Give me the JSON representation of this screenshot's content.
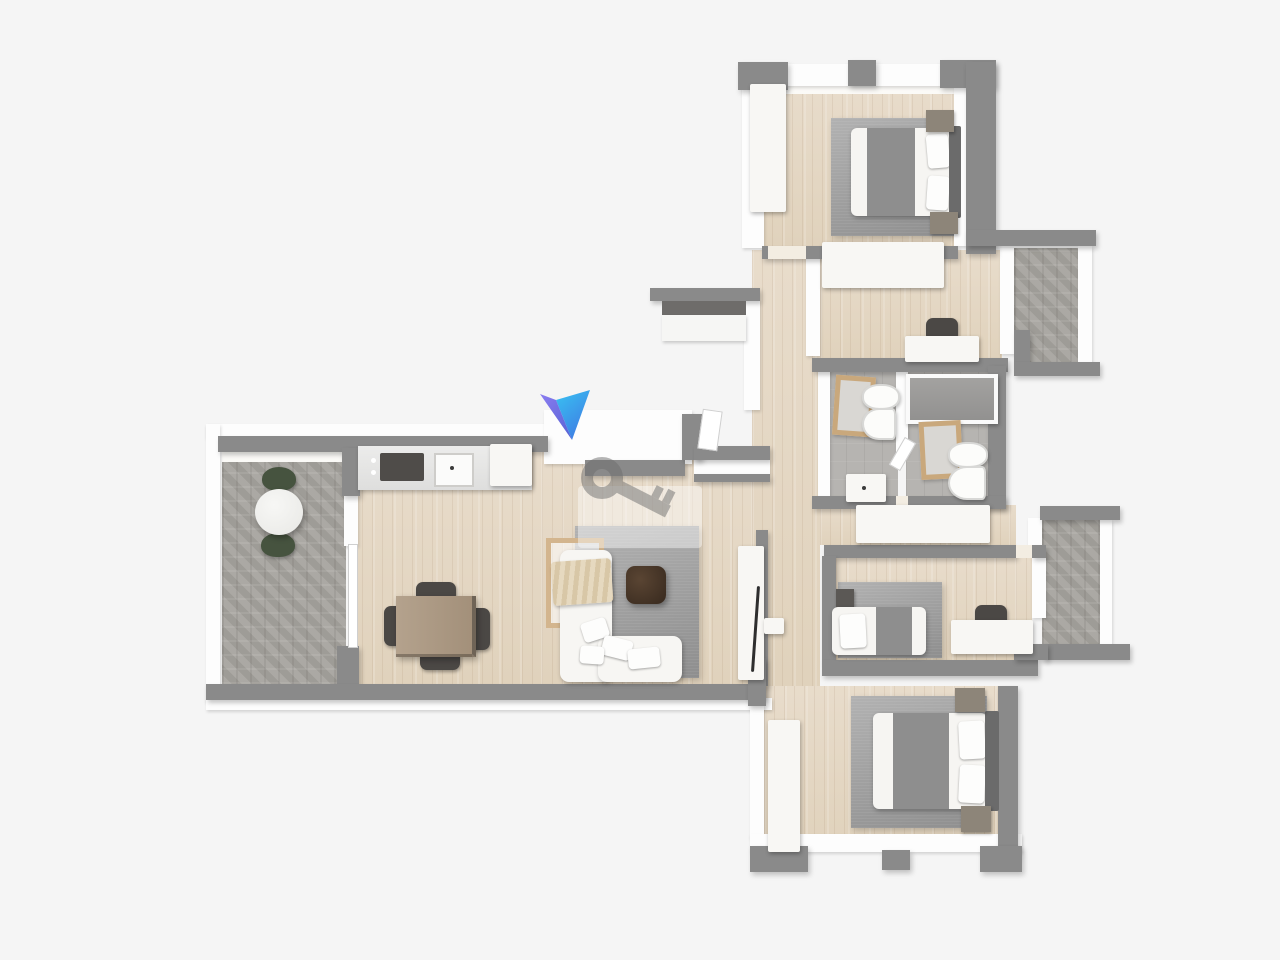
{
  "scene": {
    "type": "3d-floor-plan-top-down-render",
    "title": "apartment-floor-plan",
    "background": "#f5f5f5",
    "marker": {
      "icon": "camera-direction-marker",
      "colors": [
        "#8a7cf0",
        "#38c3f2",
        "#3f7ee4"
      ]
    },
    "watermark": {
      "icon": "key-logo-watermark",
      "color": "#6e6e6e",
      "opacity": 0.5
    }
  },
  "palette": {
    "bg": "#f5f5f5",
    "wall": "#8a8a8a",
    "wallw": "#fdfdfd",
    "wood": "#e4d7c4",
    "tile": "#a7a49f",
    "bath": "#b6b4b1",
    "rug": "#9a9a9a",
    "blanket": "#8e8e8e",
    "hboard": "#6b6b6b",
    "nstand": "#8d8579",
    "chair": "#4b4845",
    "green": "#46533f",
    "matframe": "#c9a87c",
    "tablewood": "#a8937c",
    "coffeetable": "#3e2f27"
  },
  "rooms": [
    {
      "id": "terrace",
      "floor": "stone-tile",
      "furniture": [
        "round-bistro-table",
        "green-chair",
        "green-chair"
      ]
    },
    {
      "id": "kitchen",
      "floor": "wood",
      "furniture": [
        "kitchen-counter",
        "cooktop",
        "kitchen-sink",
        "tall-unit"
      ]
    },
    {
      "id": "living-dining-room",
      "floor": "wood",
      "furniture": [
        "dining-table",
        "dining-chair",
        "dining-chair",
        "dining-chair",
        "dining-chair",
        "corner-sofa",
        "throw-blanket",
        "cushions",
        "coffee-table",
        "area-rug",
        "console-table",
        "tv-cabinet"
      ]
    },
    {
      "id": "entry-hall",
      "floor": "wood",
      "furniture": [
        "built-in-closet"
      ]
    },
    {
      "id": "bedroom-1",
      "floor": "wood",
      "furniture": [
        "double-bed",
        "area-rug",
        "wardrobe",
        "nightstand",
        "nightstand"
      ]
    },
    {
      "id": "study",
      "floor": "wood",
      "furniture": [
        "sideboard",
        "desk",
        "office-chair"
      ]
    },
    {
      "id": "balcony-1",
      "floor": "stone-tile",
      "furniture": []
    },
    {
      "id": "bathroom-1",
      "floor": "stone-tile",
      "furniture": [
        "bath-mat",
        "bidet",
        "toilet",
        "sink-vanity"
      ]
    },
    {
      "id": "bathroom-2",
      "floor": "stone-tile",
      "furniture": [
        "shower",
        "bath-mat",
        "bidet",
        "toilet"
      ]
    },
    {
      "id": "hallway",
      "floor": "wood",
      "furniture": [
        "wardrobe-cabinet"
      ]
    },
    {
      "id": "bedroom-3",
      "floor": "wood",
      "furniture": [
        "single-bed",
        "area-rug",
        "desk",
        "office-chair",
        "bedside-unit"
      ]
    },
    {
      "id": "balcony-2",
      "floor": "stone-tile",
      "furniture": []
    },
    {
      "id": "bedroom-2",
      "floor": "wood",
      "furniture": [
        "double-bed",
        "area-rug",
        "wardrobe",
        "nightstand",
        "nightstand"
      ]
    }
  ]
}
